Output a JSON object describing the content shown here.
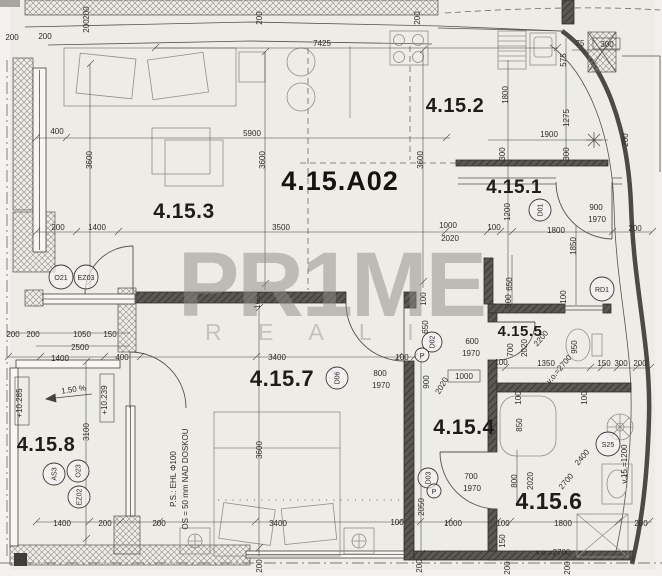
{
  "watermark": {
    "line1": "PR1ME",
    "line2": "R E A L I"
  },
  "apartment_label": "4.15.A02",
  "rooms": {
    "r1": "4.15.1",
    "r2": "4.15.2",
    "r3": "4.15.3",
    "r4": "4.15.4",
    "r5": "4.15.5",
    "r6": "4.15.6",
    "r7": "4.15.7",
    "r8": "4.15.8"
  },
  "tags": {
    "o21": "O21",
    "ez03": "EZ03",
    "as3": "AS3",
    "o23": "O23",
    "ez02": "EZ02",
    "d01": "D01",
    "d02": "D02",
    "d03": "D03",
    "d06": "D06",
    "rd1": "RD1",
    "s25": "S25",
    "p": "P"
  },
  "notes": {
    "slope": "1.50 %",
    "level_a": "+10.285",
    "level_b": "+10.239",
    "ps_line1": "P.S.: EHL Φ100",
    "ps_line2": "OS = 50 mm NAD DOSKOU"
  },
  "dims": [
    "7425",
    "200",
    "200",
    "200",
    "200",
    "200",
    "200",
    "5900",
    "400",
    "3600",
    "3600",
    "3600",
    "1400",
    "200",
    "3500",
    "1000",
    "2020",
    "100",
    "1200",
    "900",
    "1970",
    "1800",
    "200",
    "1800",
    "575",
    "1275",
    "1900",
    "200",
    "75",
    "300",
    "300",
    "300",
    "1850",
    "100",
    "650",
    "300",
    "600",
    "1970",
    "700",
    "2020",
    "2200",
    "950",
    "v.o.=2700",
    "100",
    "1350",
    "150",
    "300",
    "200",
    "100",
    "100",
    "850",
    "800",
    "2020",
    "2400",
    "2700",
    "900",
    "2020",
    "1000",
    "2050",
    "700",
    "1970",
    "1000",
    "100",
    "1800",
    "200",
    "150",
    "v.o.=2700",
    "v.15.=1200",
    "200",
    "200",
    "3400",
    "100",
    "800",
    "1970",
    "3600",
    "3400",
    "100",
    "200",
    "1400",
    "200",
    "200",
    "200",
    "200",
    "200",
    "1050",
    "150",
    "2500",
    "1400",
    "400",
    "3100",
    "100",
    "100",
    "650"
  ]
}
